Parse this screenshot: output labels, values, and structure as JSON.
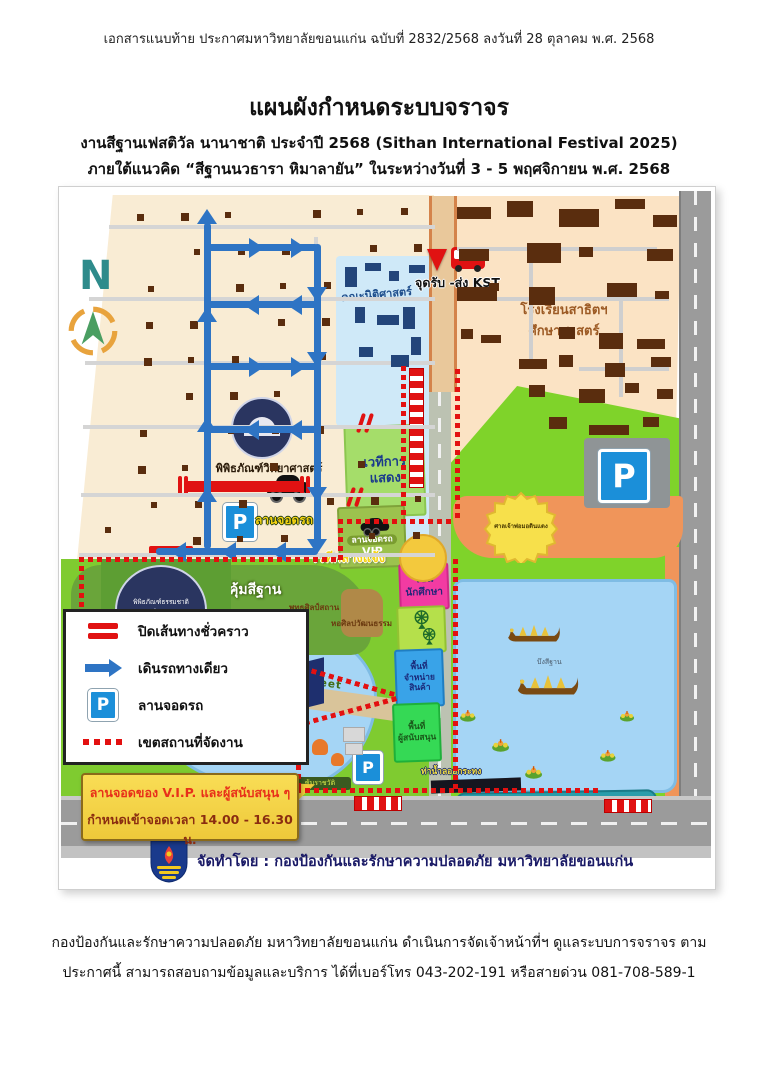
{
  "page": {
    "header_line": "เอกสารแนบท้าย  ประกาศมหาวิทยาลัยขอนแก่น ฉบับที่ 2832/2568 ลงวันที่  28 ตุลาคม พ.ศ. 2568",
    "title": "แผนผังกำหนดระบบจราจร",
    "subtitle1": "งานสีฐานเฟสติวัล นานาชาติ ประจำปี 2568 (Sithan International Festival 2025)",
    "subtitle2": "ภายใต้แนวคิด “สีฐานนวธารา หิมาลายัน” ในระหว่างวันที่ 3 - 5 พฤศจิกายน พ.ศ. 2568",
    "footer_line1": "กองป้องกันและรักษาความปลอดภัย มหาวิทยาลัยขอนแก่น ดำเนินการจัดเจ้าหน้าที่ฯ ดูแลระบบการจราจร ตาม",
    "footer_line2": "ประกาศนี้ สามารถสอบถามข้อมูลและบริการ ได้ที่เบอร์โทร 043-202-191 หรือสายด่วน 081-708-589-1"
  },
  "map": {
    "north_label": "N",
    "p_letter": "P",
    "labels": {
      "law_faculty": "คณะนิติศาสตร์",
      "kst_point": "จุดรับ -ส่ง KST",
      "satit_school_line1": "โรงเรียนสาธิตฯ",
      "satit_school_line2": "ศึกษาศาสตร์",
      "science_museum": "พิพิธภัณฑ์วิทยาศาสตร์",
      "parking_lot": "ลานจอดรถ",
      "natural_history_museum": "พิพิธภัณฑ์ธรรมชาติวิทยา",
      "khum_sithan": "คุ้มสีฐาน",
      "creative_walking_street": "Creative  Walking  Street",
      "buddhasilp": "พุทธศิลป์สถาน",
      "art_culture_hall": "หอศิลปวัฒนธรรม",
      "performance_stage_line1": "เวทีการ",
      "performance_stage_line2": "แสดง",
      "vip_parking_line1": "ลานจอดรถ",
      "vip_parking_line2": "VIP",
      "outdoor_stage": "เวทีกลางแจ้ง",
      "shrine": "ศาลเจ้าพ่อมอดินแดง",
      "student_zone_line1": "โซน",
      "student_zone_line2": "นักศึกษา",
      "merchandise_zone_line1": "พื้นที่จำหน่าย",
      "merchandise_zone_line2": "สินค้า",
      "sponsor_zone_line1": "พื้นที่",
      "sponsor_zone_line2": "ผู้สนับสนุน",
      "krathong_pier_west": "ท่าน้ำลอยกระทง",
      "krathong_pier_east": "ท่าน้ำลอยกระทง",
      "sithan_lake": "บึงสีฐาน",
      "ratchawat": "ซุ้มราชวัติ"
    },
    "legend": {
      "items": [
        {
          "label": "ปิดเส้นทางชั่วคราว"
        },
        {
          "label": "เดินรถทางเดียว"
        },
        {
          "label": "ลานจอดรถ"
        },
        {
          "label": "เขตสถานที่จัดงาน"
        }
      ]
    },
    "callout": {
      "line1": "ลานจอดของ V.I.P. และผู้สนับสนุน ๆ",
      "line2": "กำหนดเข้าจอดเวลา 14.00 - 16.30 น."
    },
    "credit": "จัดทำโดย : กองป้องกันและรักษาความปลอดภัย มหาวิทยาลัยขอนแก่น"
  },
  "colors": {
    "route_closed_red": "#e01212",
    "one_way_blue": "#2e74c4",
    "parking_blue": "#1b8fd9",
    "boundary_red": "#e31010",
    "callout_yellow": "#f7d54a",
    "park_green": "#7fd32a",
    "lake_blue": "#a5d5f5",
    "plaza_orange": "#f0955a"
  }
}
